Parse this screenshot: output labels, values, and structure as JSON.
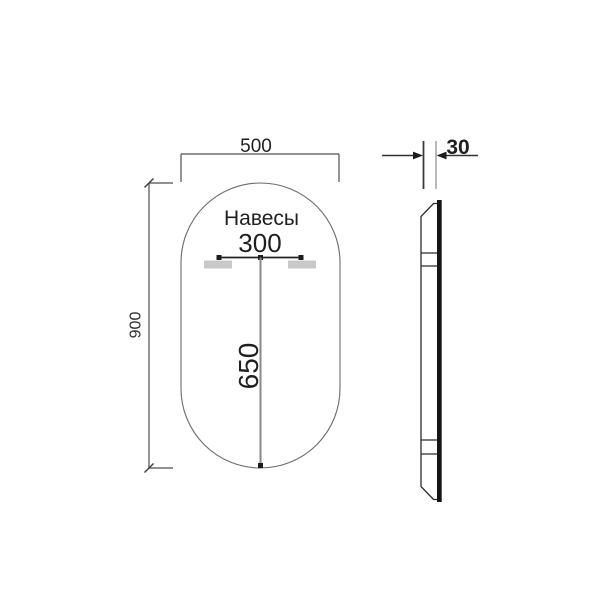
{
  "front_view": {
    "annotation": "Навесы",
    "width_mm": "500",
    "height_mm": "900",
    "hanger_spacing_mm": "300",
    "hanger_to_bottom_mm": "650"
  },
  "side_view": {
    "thickness_mm": "30"
  },
  "icons": {
    "arrow_left": "filled-triangle-left",
    "arrow_right": "filled-triangle-right"
  },
  "colors": {
    "background": "#ffffff",
    "dimension_line": "#4f4f4f",
    "mirror_outline": "#6b6b6b",
    "hanger_fill": "#c9c9c9",
    "center_line": "#8a8a8a",
    "glass_edge": "#151515",
    "text": "#1f1f1f"
  }
}
